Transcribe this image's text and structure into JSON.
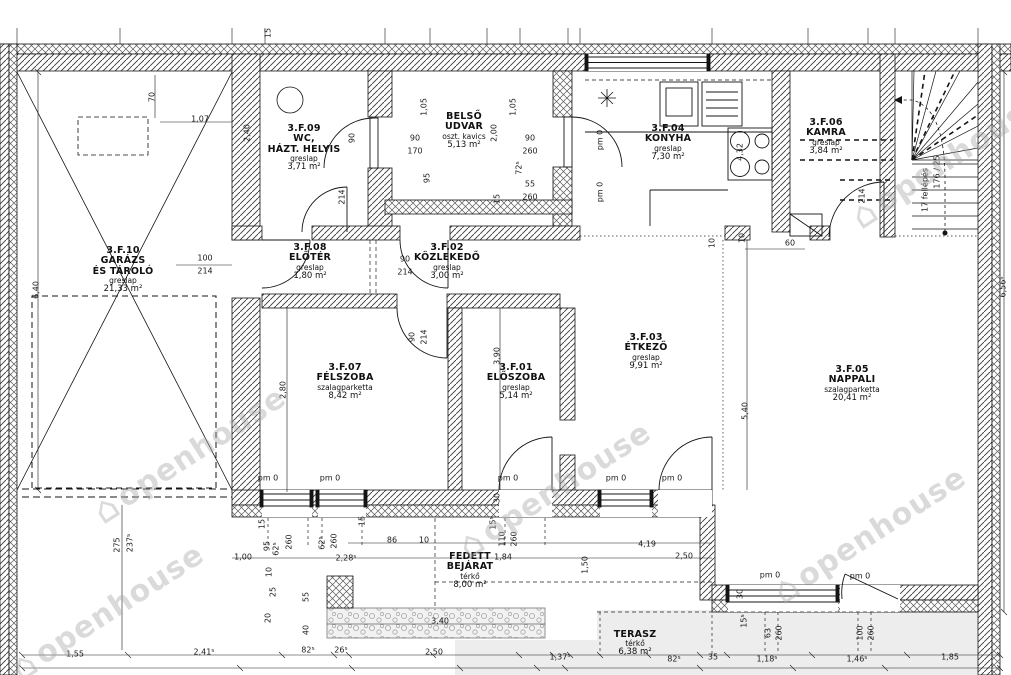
{
  "watermark": {
    "text": "openhouse",
    "positions": [
      {
        "x": 190,
        "y": 455
      },
      {
        "x": 555,
        "y": 490
      },
      {
        "x": 870,
        "y": 535
      },
      {
        "x": 948,
        "y": 160
      },
      {
        "x": 108,
        "y": 612
      }
    ]
  },
  "rooms": [
    {
      "id": "3.F.10",
      "name_lines": [
        "GARÁZS",
        "ÉS TÁROLÓ"
      ],
      "material": "greslap",
      "area": "21,33 m²",
      "x": 123,
      "y": 246
    },
    {
      "id": "3.F.09",
      "name_lines": [
        "WC,",
        "HÁZT. HELYIS"
      ],
      "material": "greslap",
      "area": "3,71 m²",
      "x": 304,
      "y": 124
    },
    {
      "id": "",
      "name_lines": [
        "BELSŐ",
        "UDVAR"
      ],
      "material": "oszt. kavics",
      "area": "5,13 m²",
      "x": 464,
      "y": 112
    },
    {
      "id": "3.F.04",
      "name_lines": [
        "KONYHA"
      ],
      "material": "greslap",
      "area": "7,30 m²",
      "x": 668,
      "y": 124
    },
    {
      "id": "3.F.06",
      "name_lines": [
        "KAMRA"
      ],
      "material": "greslap",
      "area": "3,84 m²",
      "x": 826,
      "y": 118
    },
    {
      "id": "3.F.08",
      "name_lines": [
        "ELŐTÉR"
      ],
      "material": "greslap",
      "area": "1,80 m²",
      "x": 310,
      "y": 243
    },
    {
      "id": "3.F.02",
      "name_lines": [
        "KÖZLEKEDŐ"
      ],
      "material": "greslap",
      "area": "3,00 m²",
      "x": 447,
      "y": 243
    },
    {
      "id": "3.F.07",
      "name_lines": [
        "FÉLSZOBA"
      ],
      "material": "szalagparketta",
      "area": "8,42 m²",
      "x": 345,
      "y": 363
    },
    {
      "id": "3.F.01",
      "name_lines": [
        "ELŐSZOBA"
      ],
      "material": "greslap",
      "area": "5,14 m²",
      "x": 516,
      "y": 363
    },
    {
      "id": "3.F.03",
      "name_lines": [
        "ÉTKEZŐ"
      ],
      "material": "greslap",
      "area": "9,91 m²",
      "x": 646,
      "y": 333
    },
    {
      "id": "3.F.05",
      "name_lines": [
        "NAPPALI"
      ],
      "material": "szalagparketta",
      "area": "20,41 m²",
      "x": 852,
      "y": 365
    },
    {
      "id": "",
      "name_lines": [
        "FEDETT",
        "BEJÁRAT"
      ],
      "material": "térkő",
      "area": "8,00 m²",
      "x": 470,
      "y": 552
    },
    {
      "id": "",
      "name_lines": [
        "TERASZ"
      ],
      "material": "térkő",
      "area": "6,38 m²",
      "x": 635,
      "y": 630
    }
  ],
  "dimensions": [
    {
      "t": "70",
      "x": 152,
      "y": 97,
      "r": 1
    },
    {
      "t": "1,07",
      "x": 200,
      "y": 119
    },
    {
      "t": "2,40",
      "x": 247,
      "y": 133,
      "r": 1
    },
    {
      "t": "6,40",
      "x": 36,
      "y": 290,
      "r": 1
    },
    {
      "t": "15",
      "x": 268,
      "y": 33,
      "r": 1
    },
    {
      "t": "100",
      "x": 205,
      "y": 258
    },
    {
      "t": "214",
      "x": 205,
      "y": 271
    },
    {
      "t": "90",
      "x": 352,
      "y": 138,
      "r": 1
    },
    {
      "t": "214",
      "x": 342,
      "y": 197,
      "r": 1
    },
    {
      "t": "1,05",
      "x": 424,
      "y": 107,
      "r": 1
    },
    {
      "t": "95",
      "x": 427,
      "y": 178,
      "r": 1
    },
    {
      "t": "90",
      "x": 415,
      "y": 138
    },
    {
      "t": "170",
      "x": 415,
      "y": 151
    },
    {
      "t": "2,00",
      "x": 494,
      "y": 133,
      "r": 1
    },
    {
      "t": "1,05",
      "x": 513,
      "y": 107,
      "r": 1
    },
    {
      "t": "90",
      "x": 530,
      "y": 138
    },
    {
      "t": "260",
      "x": 530,
      "y": 151
    },
    {
      "t": "72⁵",
      "x": 519,
      "y": 168,
      "r": 1
    },
    {
      "t": "55",
      "x": 530,
      "y": 184
    },
    {
      "t": "260",
      "x": 530,
      "y": 197
    },
    {
      "t": "15",
      "x": 497,
      "y": 199,
      "r": 1
    },
    {
      "t": "pm 0",
      "x": 600,
      "y": 140,
      "r": 1
    },
    {
      "t": "pm 0",
      "x": 600,
      "y": 192,
      "r": 1
    },
    {
      "t": "4,32",
      "x": 740,
      "y": 152,
      "r": 1
    },
    {
      "t": "10",
      "x": 742,
      "y": 238,
      "r": 1
    },
    {
      "t": "10",
      "x": 712,
      "y": 243,
      "r": 1
    },
    {
      "t": "60",
      "x": 790,
      "y": 243
    },
    {
      "t": "214",
      "x": 862,
      "y": 196,
      "r": 1
    },
    {
      "t": "17 fellépés",
      "x": 925,
      "y": 190,
      "r": 1
    },
    {
      "t": "176 / 25",
      "x": 937,
      "y": 172,
      "r": 1
    },
    {
      "t": "90",
      "x": 405,
      "y": 259
    },
    {
      "t": "214",
      "x": 405,
      "y": 272
    },
    {
      "t": "90",
      "x": 412,
      "y": 337,
      "r": 1
    },
    {
      "t": "214",
      "x": 424,
      "y": 337,
      "r": 1
    },
    {
      "t": "2,80",
      "x": 283,
      "y": 390,
      "r": 1
    },
    {
      "t": "3,90",
      "x": 497,
      "y": 356,
      "r": 1
    },
    {
      "t": "5,40",
      "x": 745,
      "y": 411,
      "r": 1
    },
    {
      "t": "6,56⁵",
      "x": 1003,
      "y": 287,
      "r": 1
    },
    {
      "t": "pm 0",
      "x": 268,
      "y": 478
    },
    {
      "t": "pm 0",
      "x": 330,
      "y": 478
    },
    {
      "t": "pm 0",
      "x": 508,
      "y": 478
    },
    {
      "t": "pm 0",
      "x": 616,
      "y": 478
    },
    {
      "t": "pm 0",
      "x": 672,
      "y": 478
    },
    {
      "t": "pm 0",
      "x": 770,
      "y": 575
    },
    {
      "t": "pm 0",
      "x": 860,
      "y": 576
    },
    {
      "t": "275",
      "x": 117,
      "y": 545,
      "r": 1
    },
    {
      "t": "237⁵",
      "x": 130,
      "y": 543,
      "r": 1
    },
    {
      "t": "15",
      "x": 262,
      "y": 524,
      "r": 1
    },
    {
      "t": "95",
      "x": 267,
      "y": 546,
      "r": 1
    },
    {
      "t": "62⁵",
      "x": 276,
      "y": 549,
      "r": 1
    },
    {
      "t": "260",
      "x": 289,
      "y": 542,
      "r": 1
    },
    {
      "t": "62⁵",
      "x": 322,
      "y": 543,
      "r": 1
    },
    {
      "t": "260",
      "x": 334,
      "y": 541,
      "r": 1
    },
    {
      "t": "15",
      "x": 362,
      "y": 521,
      "r": 1
    },
    {
      "t": "10",
      "x": 269,
      "y": 572,
      "r": 1
    },
    {
      "t": "25",
      "x": 273,
      "y": 592,
      "r": 1
    },
    {
      "t": "20",
      "x": 268,
      "y": 618,
      "r": 1
    },
    {
      "t": "55",
      "x": 306,
      "y": 597,
      "r": 1
    },
    {
      "t": "40",
      "x": 306,
      "y": 630,
      "r": 1
    },
    {
      "t": "86",
      "x": 392,
      "y": 540
    },
    {
      "t": "10",
      "x": 424,
      "y": 540
    },
    {
      "t": "1,00",
      "x": 243,
      "y": 557
    },
    {
      "t": "2,28⁵",
      "x": 346,
      "y": 558
    },
    {
      "t": "30",
      "x": 497,
      "y": 498,
      "r": 1
    },
    {
      "t": "15⁵",
      "x": 493,
      "y": 523,
      "r": 1
    },
    {
      "t": "110",
      "x": 502,
      "y": 539,
      "r": 1
    },
    {
      "t": "260",
      "x": 514,
      "y": 539,
      "r": 1
    },
    {
      "t": "1,84",
      "x": 503,
      "y": 557
    },
    {
      "t": "1,50",
      "x": 585,
      "y": 565,
      "r": 1
    },
    {
      "t": "4,19",
      "x": 647,
      "y": 544
    },
    {
      "t": "2,50",
      "x": 684,
      "y": 556
    },
    {
      "t": "30",
      "x": 740,
      "y": 594,
      "r": 1
    },
    {
      "t": "15⁵",
      "x": 744,
      "y": 621,
      "r": 1
    },
    {
      "t": "3,40",
      "x": 440,
      "y": 621
    },
    {
      "t": "63",
      "x": 768,
      "y": 633,
      "r": 1
    },
    {
      "t": "260",
      "x": 779,
      "y": 633,
      "r": 1
    },
    {
      "t": "100",
      "x": 860,
      "y": 633,
      "r": 1
    },
    {
      "t": "260",
      "x": 871,
      "y": 633,
      "r": 1
    },
    {
      "t": "1,55",
      "x": 75,
      "y": 654
    },
    {
      "t": "2,41⁵",
      "x": 204,
      "y": 652
    },
    {
      "t": "82⁵",
      "x": 308,
      "y": 650
    },
    {
      "t": "26⁵",
      "x": 341,
      "y": 650
    },
    {
      "t": "2,50",
      "x": 434,
      "y": 652
    },
    {
      "t": "1,37⁵",
      "x": 560,
      "y": 657
    },
    {
      "t": "82⁵",
      "x": 674,
      "y": 659
    },
    {
      "t": "35",
      "x": 713,
      "y": 657
    },
    {
      "t": "1,18⁵",
      "x": 767,
      "y": 659
    },
    {
      "t": "1,46⁵",
      "x": 857,
      "y": 659
    },
    {
      "t": "1,85",
      "x": 950,
      "y": 657
    }
  ]
}
